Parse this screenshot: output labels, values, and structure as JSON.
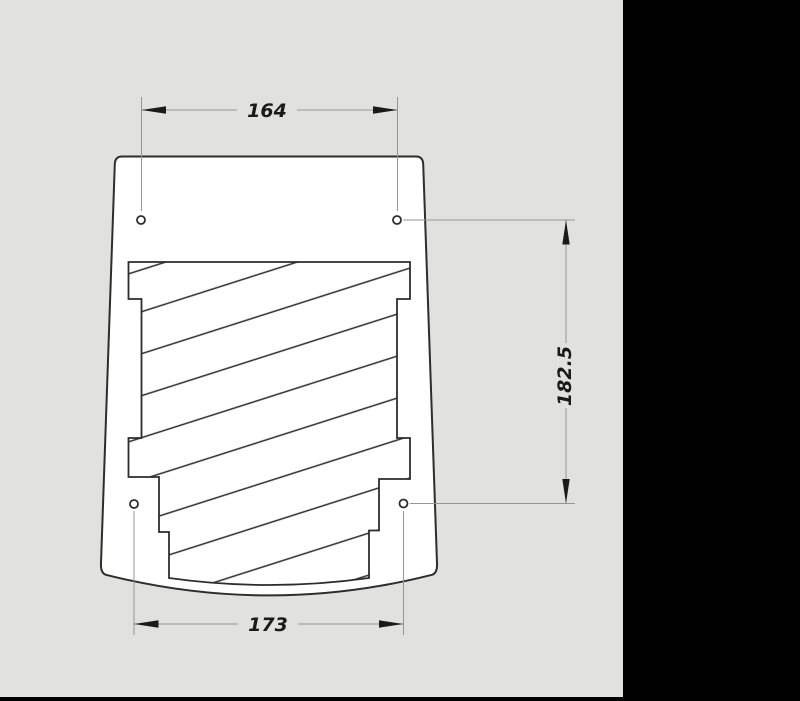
{
  "canvas": {
    "background_color": "#e1e1e0",
    "panel_color": "#000000"
  },
  "drawing": {
    "kind": "technical-dimension-drawing",
    "holes_count": 4,
    "dimensions": {
      "top_width": {
        "value": "164"
      },
      "bottom_width": {
        "value": "173"
      },
      "side_height": {
        "value": "182.5"
      }
    },
    "colors": {
      "outline": "#2d2d2d",
      "hatch_line": "#2d2d2d",
      "dimension_line": "#969696",
      "arrow_and_text": "#1a1a1a",
      "part_fill": "#ffffff"
    }
  }
}
